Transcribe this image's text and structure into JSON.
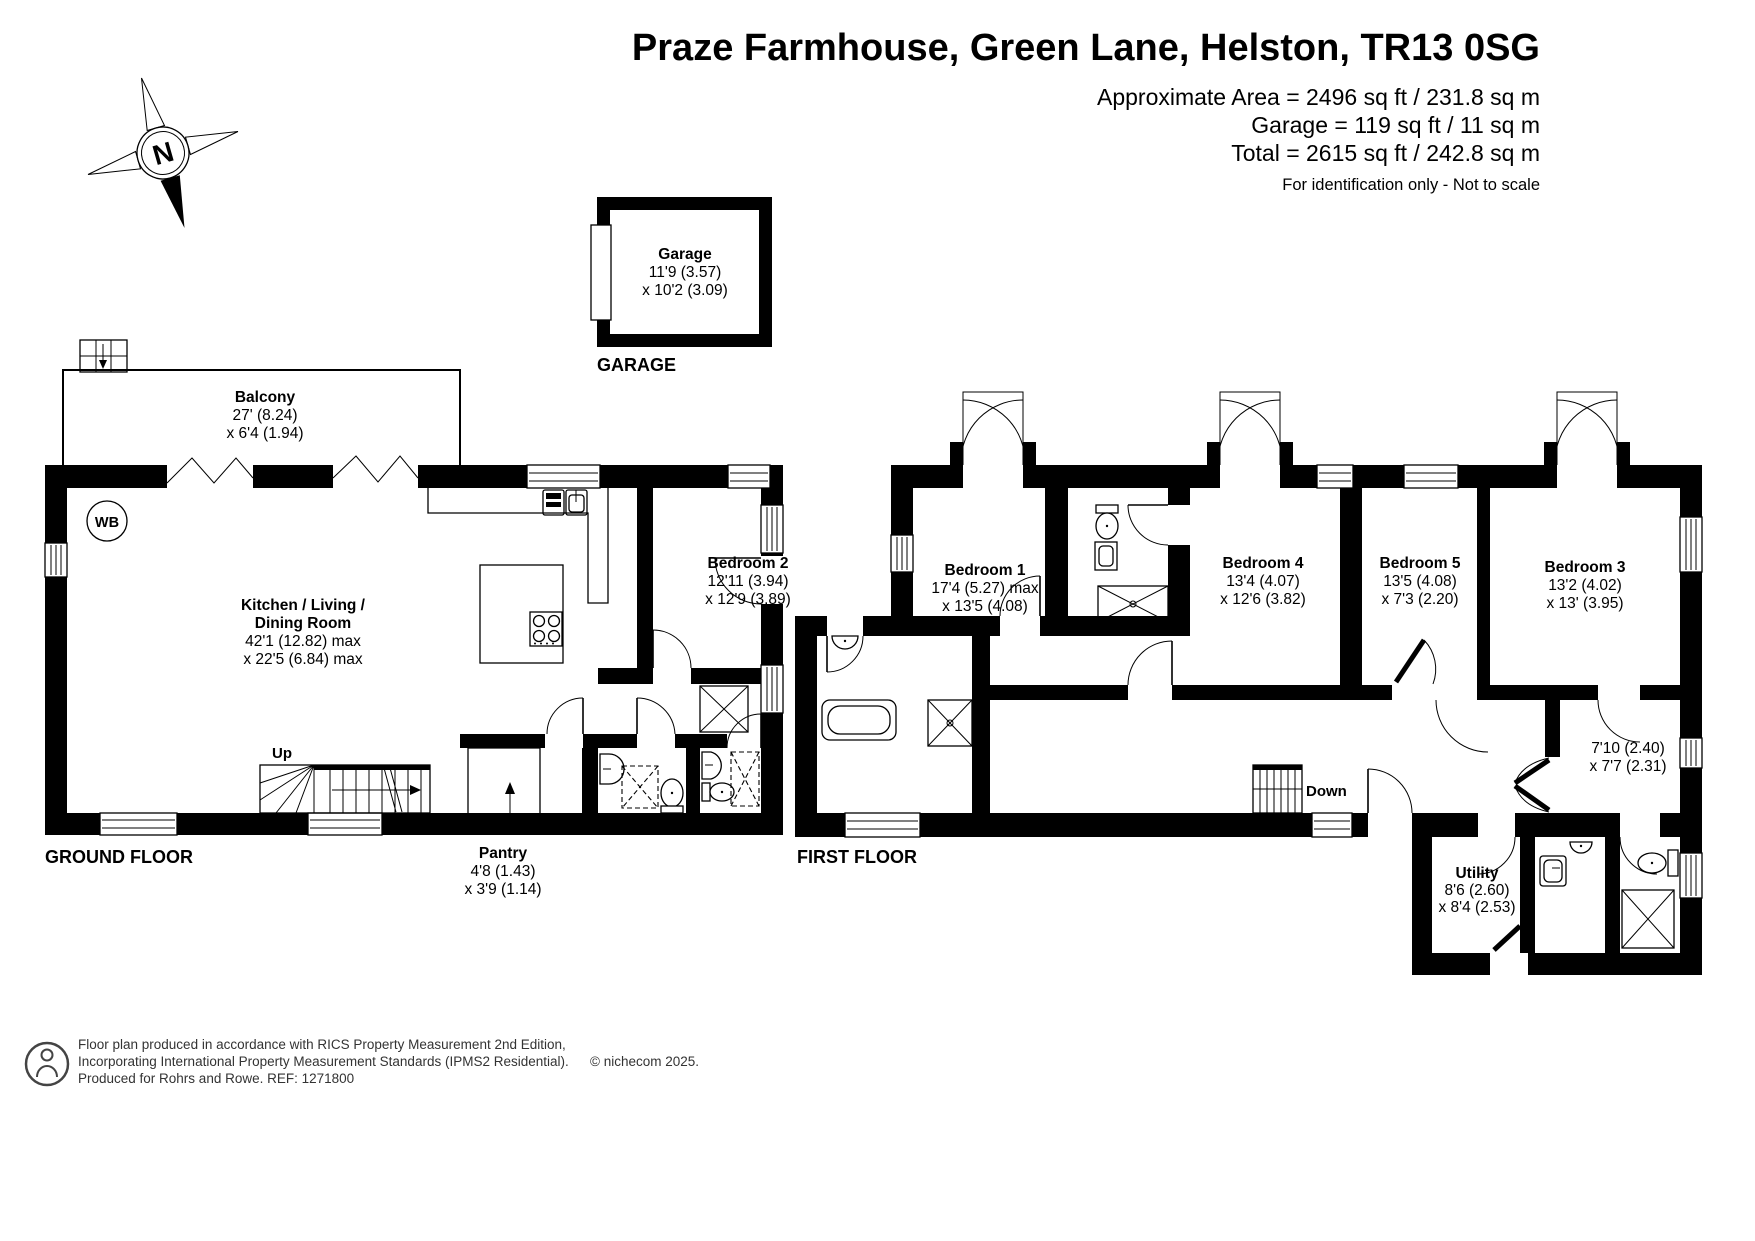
{
  "header": {
    "title": "Praze Farmhouse, Green Lane, Helston, TR13 0SG",
    "area1": "Approximate Area = 2496 sq ft / 231.8 sq m",
    "area2": "Garage = 119 sq ft / 11 sq m",
    "area3": "Total = 2615 sq ft / 242.8 sq m",
    "note": "For identification only - Not to scale"
  },
  "compass": {
    "n": "N"
  },
  "garage": {
    "label": "GARAGE",
    "room": {
      "name": "Garage",
      "d1": "11'9 (3.57)",
      "d2": "x 10'2 (3.09)"
    }
  },
  "ground_floor": {
    "label": "GROUND FLOOR",
    "wb": "WB",
    "up": "Up",
    "balcony": {
      "name": "Balcony",
      "d1": "27' (8.24)",
      "d2": "x 6'4 (1.94)"
    },
    "kitchen": {
      "name1": "Kitchen / Living /",
      "name2": "Dining Room",
      "d1": "42'1 (12.82) max",
      "d2": "x 22'5 (6.84) max"
    },
    "bedroom2": {
      "name": "Bedroom 2",
      "d1": "12'11 (3.94)",
      "d2": "x 12'9 (3.89)"
    },
    "pantry": {
      "name": "Pantry",
      "d1": "4'8 (1.43)",
      "d2": "x 3'9 (1.14)"
    }
  },
  "first_floor": {
    "label": "FIRST FLOOR",
    "down": "Down",
    "bedroom1": {
      "name": "Bedroom 1",
      "d1": "17'4 (5.27) max",
      "d2": "x 13'5 (4.08)"
    },
    "bedroom4": {
      "name": "Bedroom 4",
      "d1": "13'4 (4.07)",
      "d2": "x 12'6 (3.82)"
    },
    "bedroom5": {
      "name": "Bedroom 5",
      "d1": "13'5 (4.08)",
      "d2": "x 7'3 (2.20)"
    },
    "bedroom3": {
      "name": "Bedroom 3",
      "d1": "13'2 (4.02)",
      "d2": "x 13' (3.95)"
    },
    "store": {
      "d1": "7'10 (2.40)",
      "d2": "x 7'7 (2.31)"
    },
    "utility": {
      "name": "Utility",
      "d1": "8'6 (2.60)",
      "d2": "x 8'4 (2.53)"
    }
  },
  "footer": {
    "line1": "Floor plan produced in accordance with RICS Property Measurement 2nd Edition,",
    "line2": "Incorporating International Property Measurement Standards (IPMS2 Residential).",
    "line3": "Produced for Rohrs and Rowe.   REF: 1271800",
    "copyright": "© nichecom 2025."
  },
  "colors": {
    "wall": "#000000",
    "background": "#ffffff",
    "footer_text": "#333333"
  }
}
